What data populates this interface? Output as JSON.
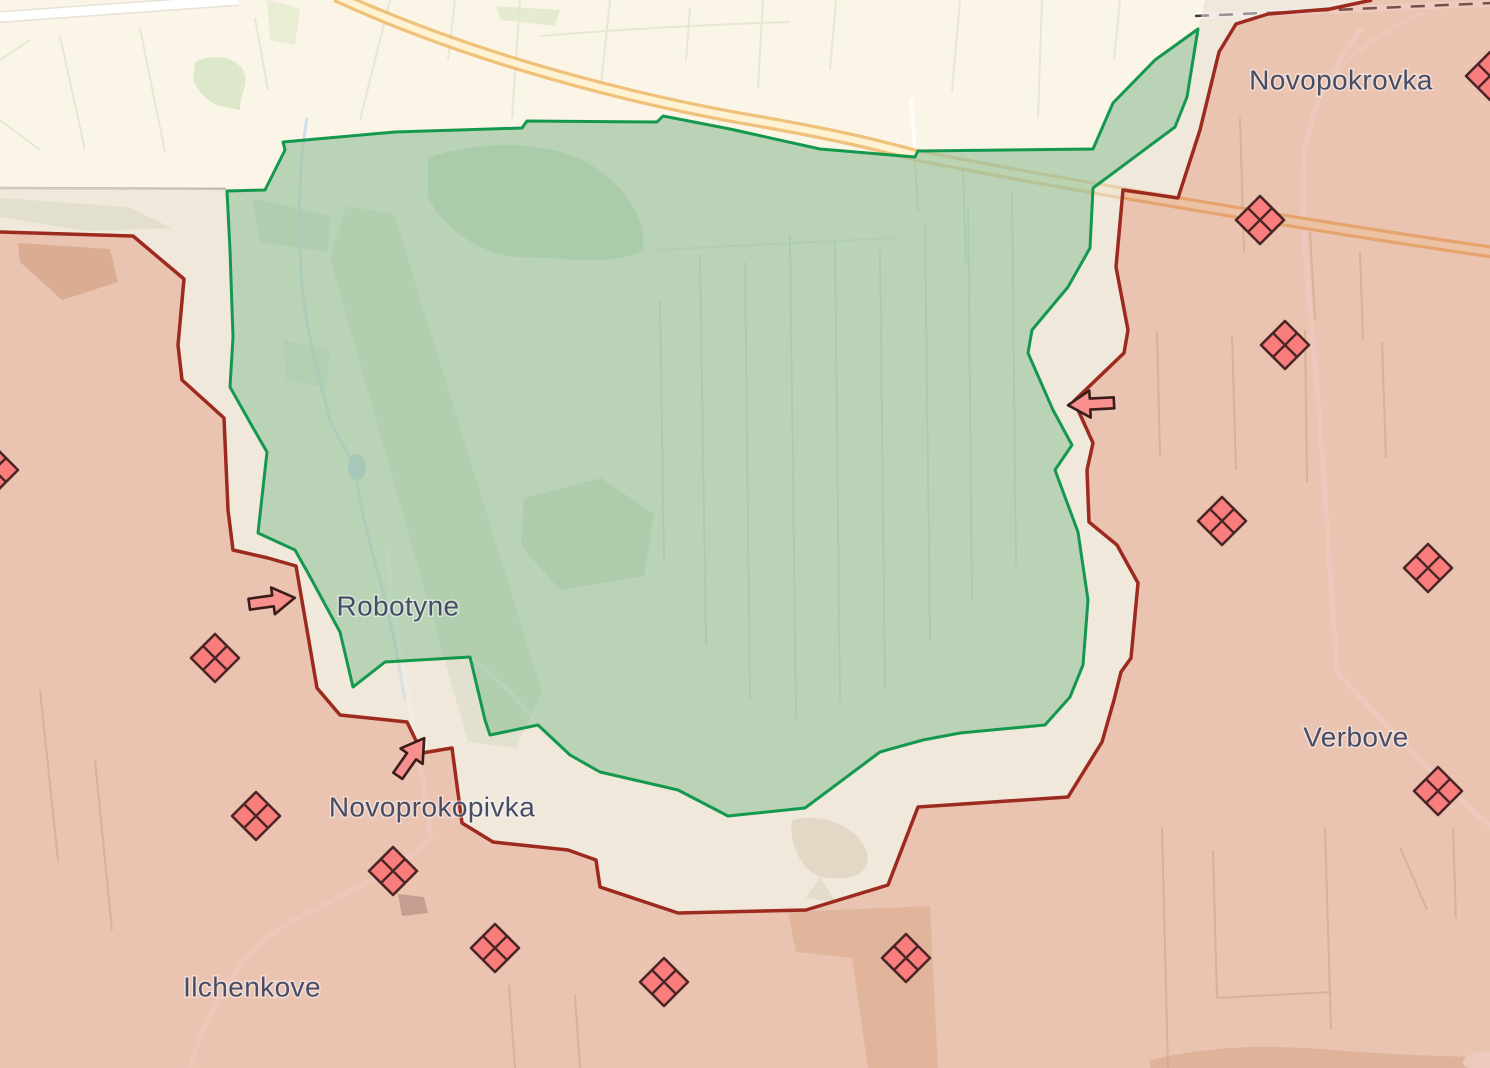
{
  "map": {
    "type": "frontline-situation-map",
    "labels": [
      {
        "id": "novopokrovka",
        "text": "Novopokrovka",
        "x": 1341,
        "y": 82
      },
      {
        "id": "robotyne",
        "text": "Robotyne",
        "x": 398,
        "y": 608
      },
      {
        "id": "novoprokopivka",
        "text": "Novoprokopivka",
        "x": 432,
        "y": 809
      },
      {
        "id": "verbove",
        "text": "Verbove",
        "x": 1356,
        "y": 739
      },
      {
        "id": "ilchenkove",
        "text": "Ilchenkove",
        "x": 252,
        "y": 989
      }
    ],
    "fortification_markers": [
      [
        1490,
        76
      ],
      [
        1260,
        220
      ],
      [
        1285,
        345
      ],
      [
        1222,
        521
      ],
      [
        1428,
        568
      ],
      [
        1438,
        791
      ],
      [
        -6,
        470
      ],
      [
        215,
        658
      ],
      [
        256,
        816
      ],
      [
        393,
        871
      ],
      [
        495,
        948
      ],
      [
        664,
        982
      ],
      [
        906,
        958
      ]
    ],
    "attack_arrows": [
      {
        "x": 272,
        "y": 601,
        "angle": -8
      },
      {
        "x": 411,
        "y": 757,
        "angle": -55
      },
      {
        "x": 1091,
        "y": 404,
        "angle": 177
      }
    ],
    "colors": {
      "base_map": "#faf5e7",
      "liberated_fill": "#bfdbbf",
      "liberated_border": "#14984e",
      "occupied_fill": "#eac3b5",
      "occupied_border": "#9d2a1e",
      "gray_zone_fill": "#eee7db",
      "marker_fill": "#fa7d7d",
      "marker_border": "#4a2626",
      "arrow_fill": "#f89090",
      "arrow_border": "#391d18",
      "highway": "#edb766",
      "label_color": "#474d66"
    }
  }
}
